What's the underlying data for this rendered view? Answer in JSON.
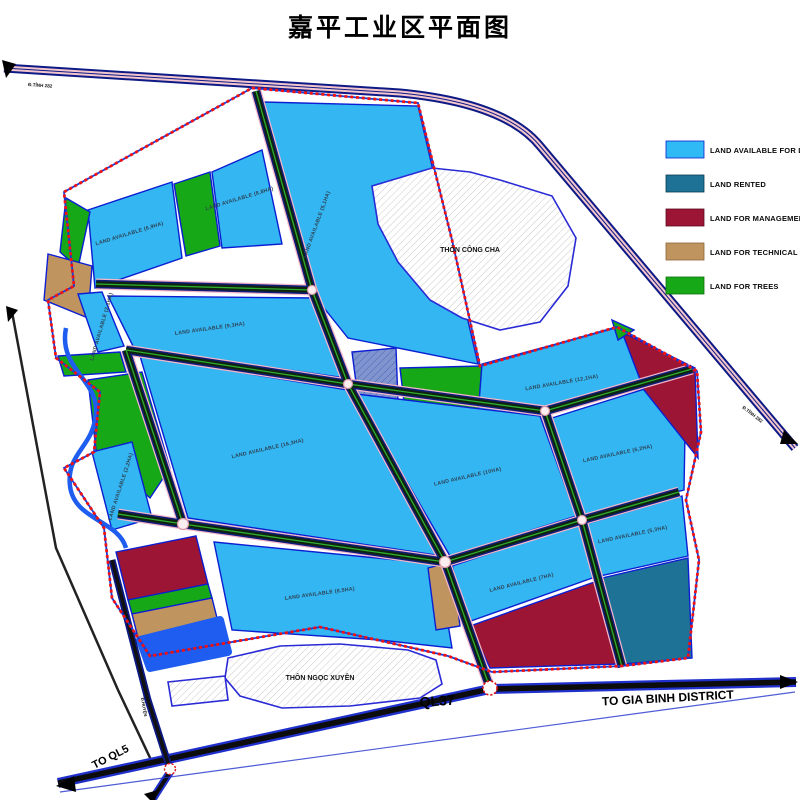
{
  "title": "嘉平工业区平面图",
  "legend": {
    "items": [
      {
        "label": "LAND AVAILABLE FOR LEASE",
        "color": "#2fb9f5"
      },
      {
        "label": "LAND RENTED",
        "color": "#1d7296"
      },
      {
        "label": "LAND FOR MANAGEMENT",
        "color": "#9c1535"
      },
      {
        "label": "LAND FOR TECHNICAL",
        "color": "#c0945f"
      },
      {
        "label": "LAND FOR TREES",
        "color": "#16a816"
      }
    ]
  },
  "roads": {
    "ql37": "QL37",
    "to_gia_binh": "TO GIA BINH DISTRICT",
    "to_ql5": "TO QL5",
    "provincial_label": "Đ.TỈNH 282",
    "district_label": "Đ.HUYỆN"
  },
  "villages": {
    "northeast": "THÔN CÔNG CHA",
    "south": "THÔN NGỌC XUYÊN"
  },
  "parcels": {
    "p1": {
      "label": "LAND AVAILABLE (6,9HA)"
    },
    "p2": {
      "label": "LAND AVAILABLE (8,8HA)"
    },
    "p3": {
      "label": "LAND AVAILABLE (5,1HA)"
    },
    "p4": {
      "label": "LAND AVAILABLE (9,3HA)"
    },
    "p5": {
      "label": "LAND AVAILABLE (16,3HA)"
    },
    "p7": {
      "label": "LAND AVAILABLE (8,5HA)"
    },
    "p8": {
      "label": "LAND AVAILABLE (10HA)"
    },
    "p9": {
      "label": "LAND AVAILABLE (12,1HA)"
    },
    "p10": {
      "label": "LAND AVAILABLE (6,2HA)"
    },
    "p11": {
      "label": "LAND AVAILABLE (5,3HA)"
    },
    "p13": {
      "label": "LAND AVAILABLE (7HA)"
    },
    "n1": {
      "label": "LAND AVAILABLE (2,1HA)"
    },
    "n2": {
      "label": "LAND AVAILABLE (2,2HA)"
    }
  }
}
